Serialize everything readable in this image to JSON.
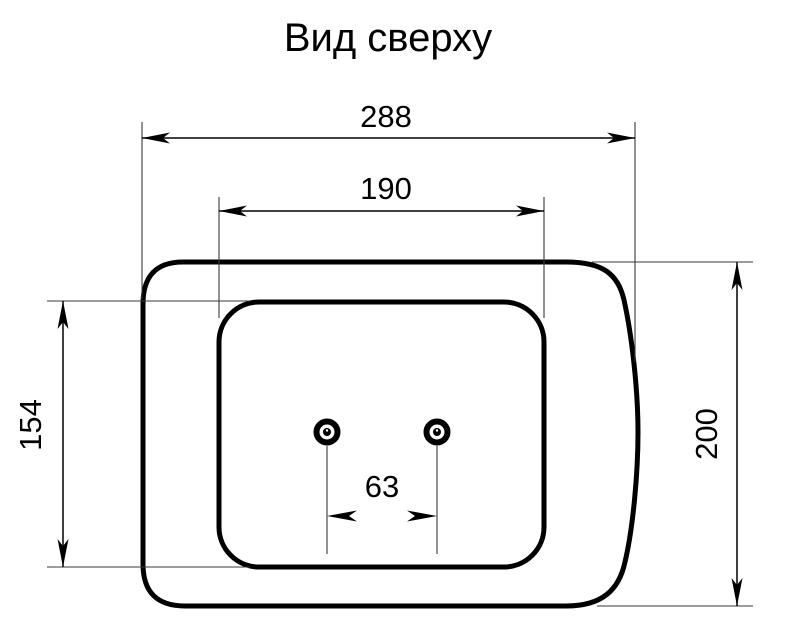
{
  "title": "Вид сверху",
  "dimensions": {
    "overall_width": "288",
    "panel_width": "190",
    "panel_height": "154",
    "overall_height": "200",
    "hole_spacing": "63"
  },
  "colors": {
    "line": "#000000",
    "extension_line": "#3a3a3a",
    "background": "#ffffff"
  }
}
